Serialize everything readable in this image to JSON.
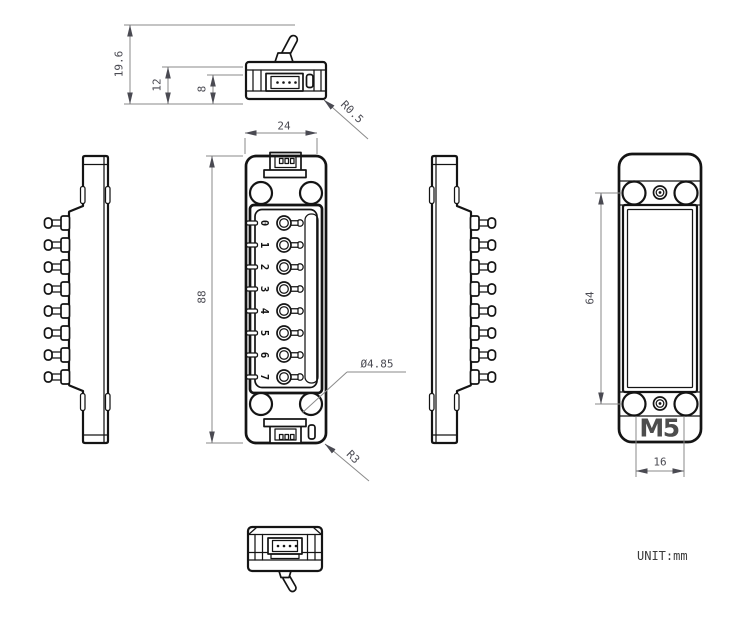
{
  "drawing": {
    "unit_note": "UNIT:mm",
    "logo": "M5",
    "dims": {
      "total_height_with_lever": "19.6",
      "upper_body_height": "12",
      "base_height": "8",
      "width": "24",
      "corner_radius_top": "R0.5",
      "length": "88",
      "hole_diameter": "Ø4.85",
      "corner_radius_main": "R3",
      "hole_pitch_vertical": "64",
      "hole_pitch_horizontal": "16"
    },
    "switch_labels": [
      "0",
      "1",
      "2",
      "3",
      "4",
      "5",
      "6",
      "7"
    ]
  }
}
